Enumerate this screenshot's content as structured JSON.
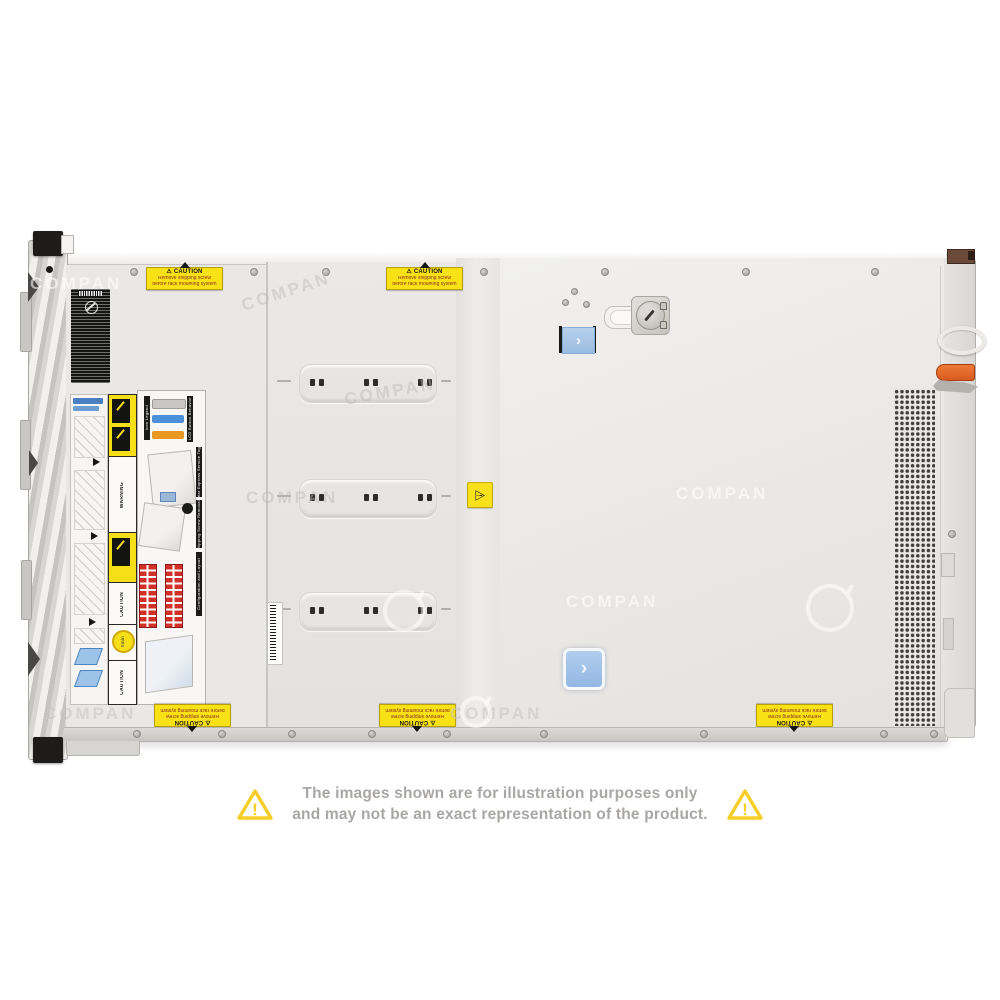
{
  "watermark": {
    "text": "COMPAN"
  },
  "disclaimer": {
    "line1": "The images shown are for illustration purposes only",
    "line2": "and may not be an exact representation of the product.",
    "warning_glyph": "!"
  },
  "stickers": {
    "caution": {
      "glyph": "⚠",
      "title": "CAUTION",
      "line1": "Remove shipping screw",
      "line2": "before rack mounting system"
    },
    "hazard_glyph": "⚠"
  },
  "service_labels": {
    "warning_title": "WARNING",
    "caution_title": "CAUTION",
    "timer_text": "5min",
    "sections": [
      "Icon Legend",
      "LCD Button Behavior",
      "Rear Express Service Tag",
      "Shipping Screw Removal",
      "Configuration and Layout"
    ]
  },
  "controls": {
    "latch_chevron": "›"
  },
  "colors": {
    "caution_yellow": "#F8E216",
    "latch_blue": "#A9C8EC",
    "handle_orange": "#E2662A",
    "disclaimer_yellow": "#F5CF27",
    "disclaimer_text_gray": "#A8A7A5",
    "chassis_gray": "#E8E7E5"
  }
}
